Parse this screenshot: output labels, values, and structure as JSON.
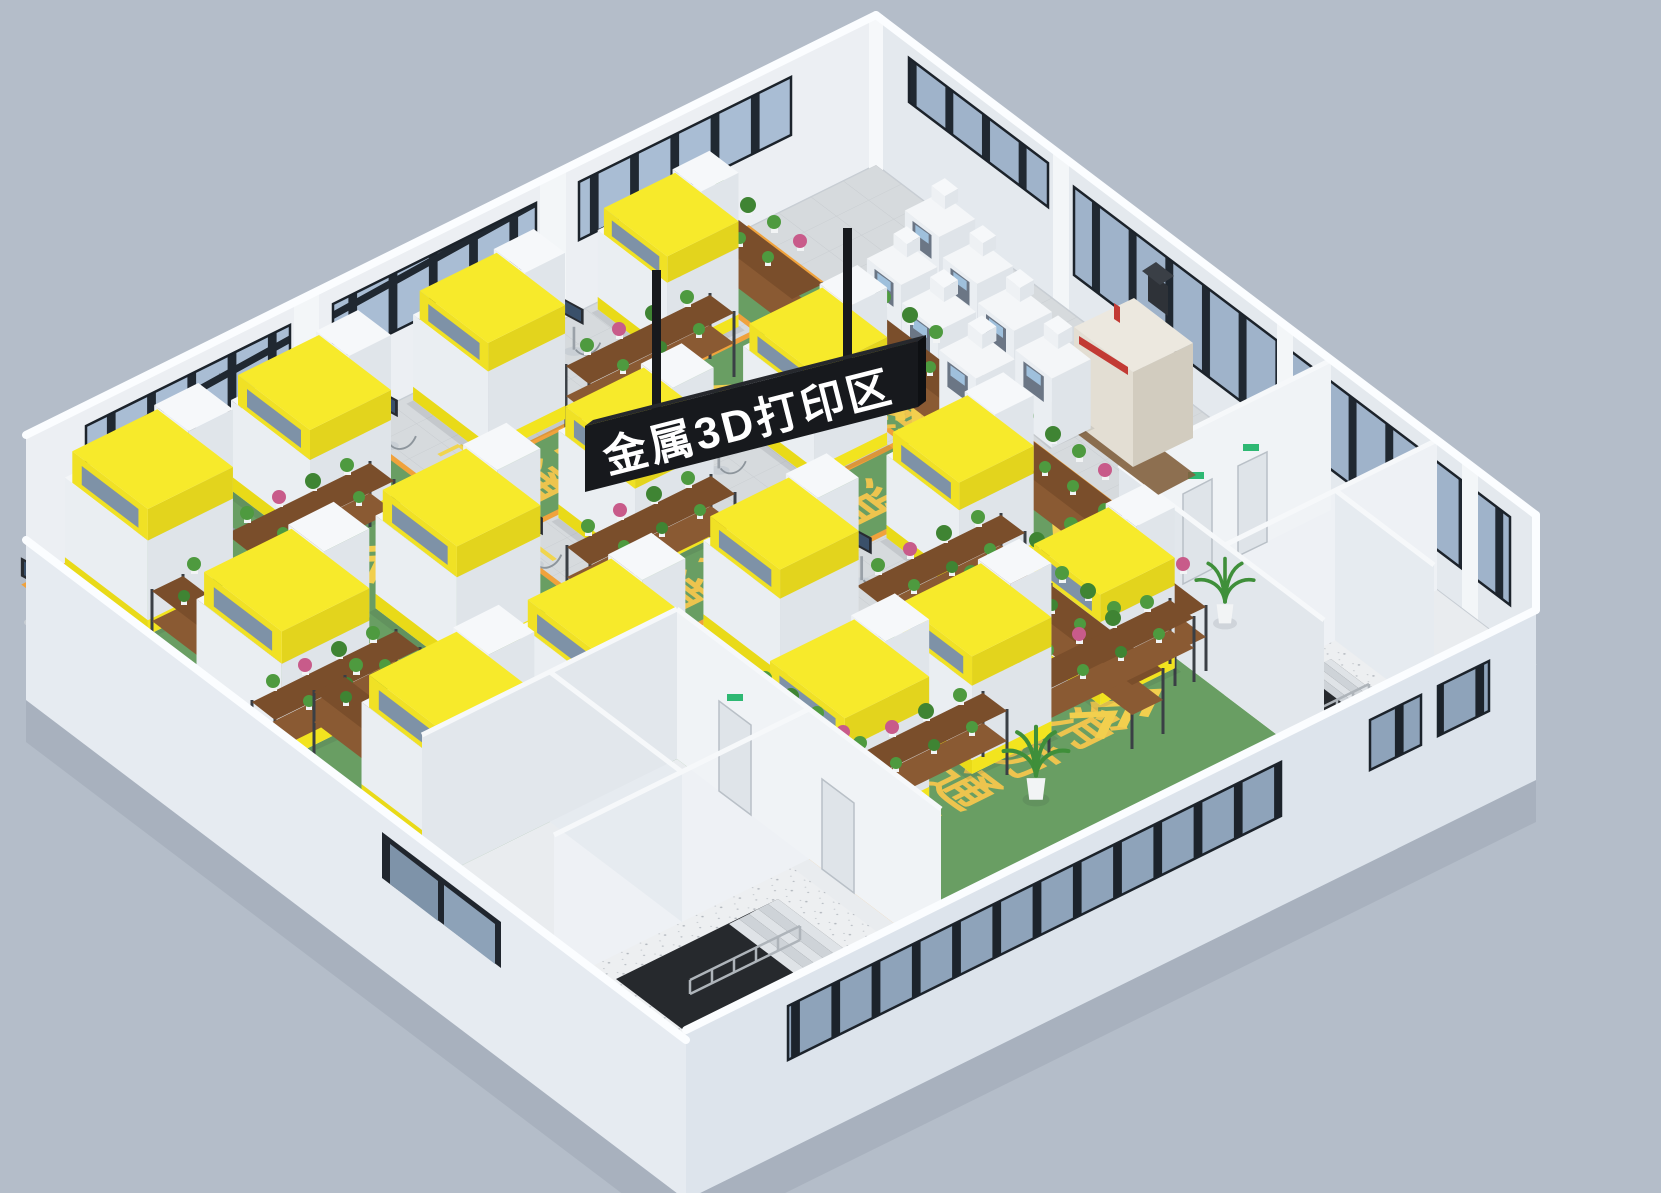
{
  "sign": {
    "text": "金属3D打印区",
    "panel_color": "#17191d",
    "panel_top_color": "#26282d",
    "text_color": "#ffffff"
  },
  "floor_markings": {
    "phrase": "消防通道",
    "chars": [
      "消",
      "防",
      "通",
      "道"
    ],
    "arrows": "<<<",
    "text_color": "#edc44e",
    "arrow_color": "#f2cf4e"
  },
  "colors": {
    "background": "#b4bdc9",
    "ground_shadow": "#9fa8b5",
    "wall_interior": "#eceff3",
    "wall_interior_shaded": "#e4e9ee",
    "wall_exterior_se": "#dde4ec",
    "wall_exterior_sw": "#e6ebf1",
    "floor_tile": "#d6dadd",
    "tile_grid": "#c7cbcf",
    "room_floor": "#e9ecef",
    "aisle_green": "#699e63",
    "aisle_border_orange": "#f0a23c",
    "machine_yellow": "#f7ea2b",
    "machine_body": "#eff1f3",
    "window_glass": "#a9bdd4",
    "window_glass_dark": "#8ea3ba",
    "window_frame": "#202831",
    "plant_green": "#4e9a3f",
    "shelf_wood": "#8a5a33",
    "exit_sign_green": "#2eb873",
    "cnc_beige": "#e8e4da",
    "cnc_red": "#c23a34",
    "stair_concrete": "#edeff1"
  }
}
